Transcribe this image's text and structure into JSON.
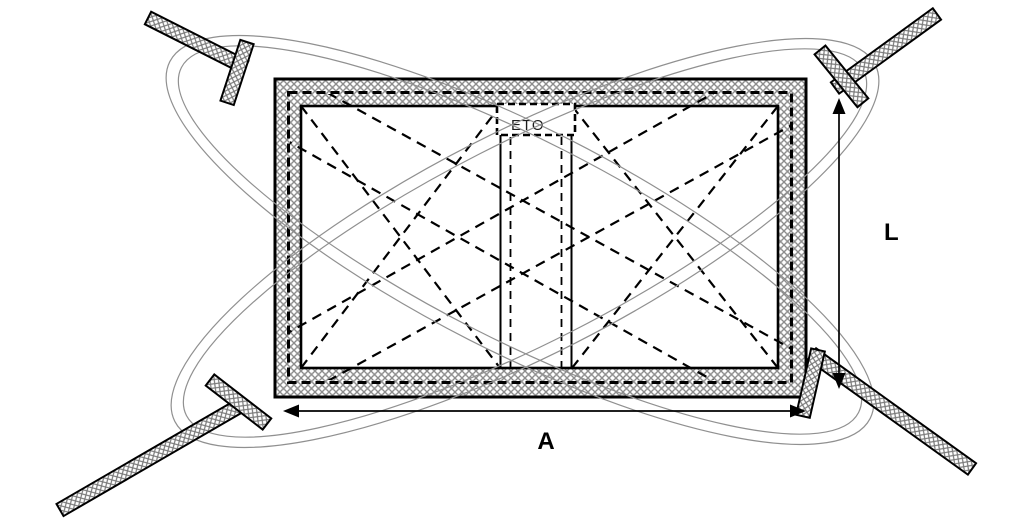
{
  "diagram": {
    "description": "Packaged window block with strapping bands, corner battens and overall dimension check",
    "labels": {
      "eto": "ETO",
      "width_dim": "A",
      "height_dim": "L"
    },
    "colors": {
      "background": "#ffffff",
      "line": "#000000",
      "hatch": "#8c8c8c",
      "strap_ellipse": "#909090"
    }
  }
}
